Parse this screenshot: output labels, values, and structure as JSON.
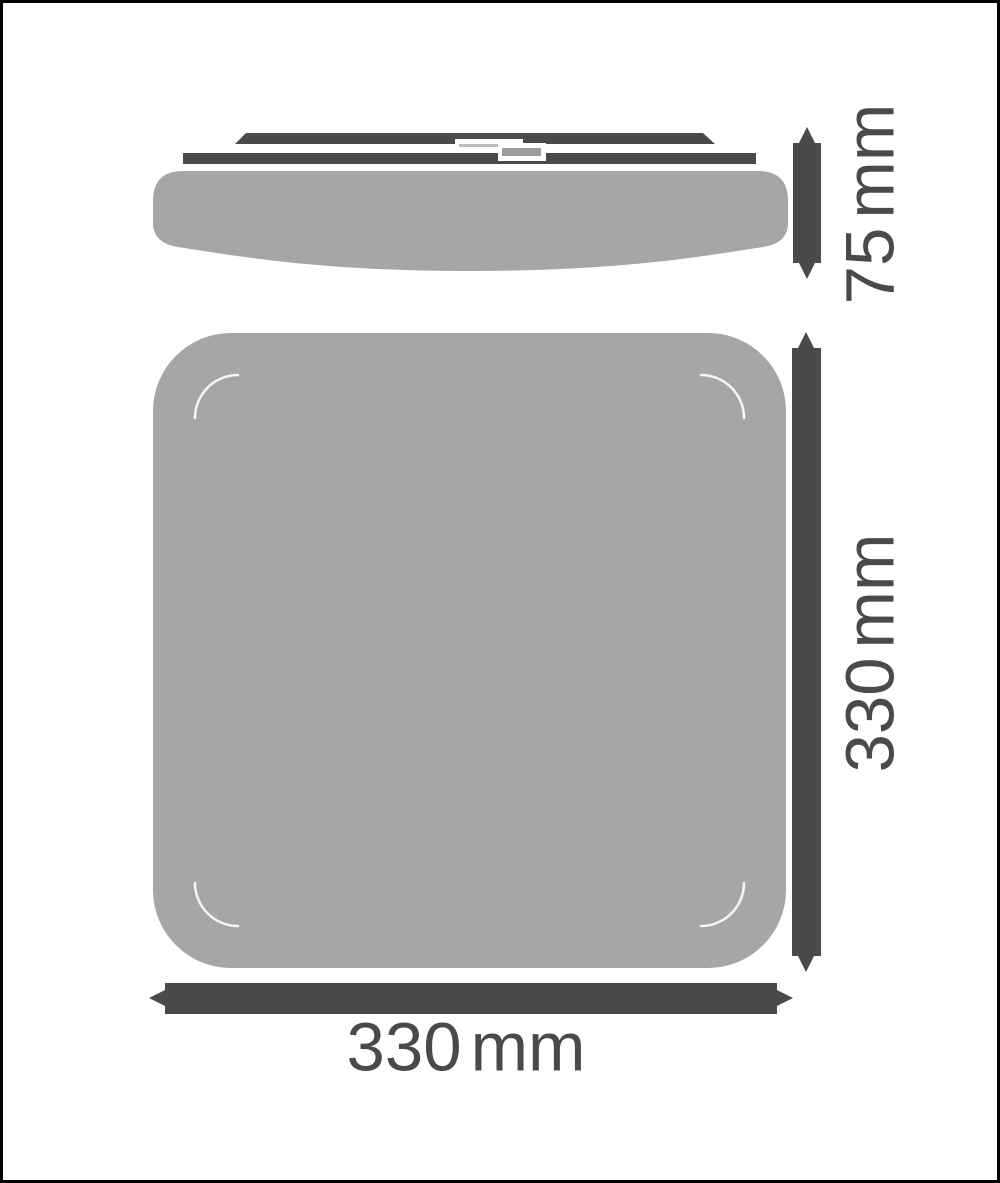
{
  "dimensions": {
    "height": {
      "value": "75",
      "unit": "mm",
      "label": "75 mm",
      "orientation": "vertical"
    },
    "front_height": {
      "value": "330",
      "unit": "mm",
      "label": "330 mm",
      "orientation": "vertical"
    },
    "front_width": {
      "value": "330",
      "unit": "mm",
      "label": "330 mm",
      "orientation": "horizontal"
    }
  },
  "colors": {
    "frame": "#000000",
    "background": "#ffffff",
    "dark_gray": "#4a4a4a",
    "light_gray_body": "#a6a6a6",
    "clip_line_gray": "#bcbcbc",
    "clip_fill_gray": "#9e9e9e",
    "corner_arc": "#ffffff",
    "label_text": "#4a4a4a"
  }
}
